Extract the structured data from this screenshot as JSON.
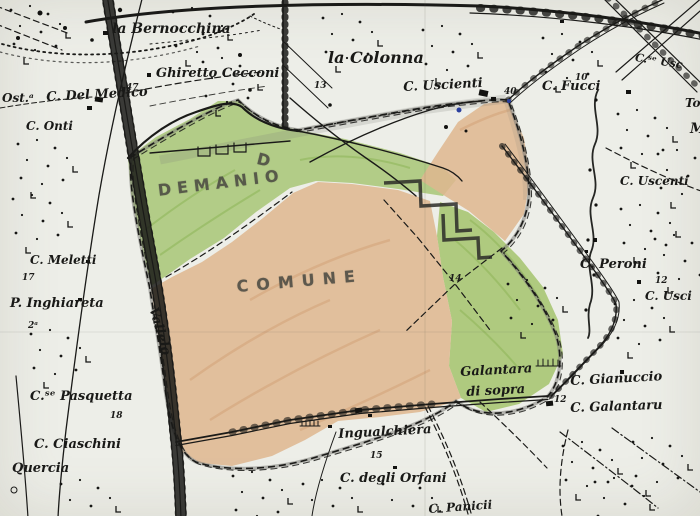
{
  "map": {
    "colors": {
      "paper": "#edeee8",
      "ink": "#1a1a18",
      "green_region": "#b2d37c",
      "orange_region": "#f0c49d",
      "pencil": "#7d7d78",
      "water_dot": "#2a3f9e"
    },
    "hand_labels": [
      {
        "t": "DEMANIO",
        "x": 157,
        "y": 183,
        "s": 16,
        "r": -7,
        "ls": 6
      },
      {
        "t": "COMUNE",
        "x": 236,
        "y": 279,
        "s": 16,
        "r": -5,
        "ls": 8
      },
      {
        "t": "D",
        "x": 259,
        "y": 151,
        "s": 16,
        "r": 14,
        "ls": 0
      }
    ],
    "place_labels": [
      {
        "t": "la Bernocchina",
        "x": 112,
        "y": 22,
        "s": 14
      },
      {
        "t": "Ghiretto Cecconi",
        "x": 156,
        "y": 67,
        "s": 13
      },
      {
        "t": "la Colonna",
        "x": 328,
        "y": 50,
        "s": 16
      },
      {
        "t": "C. Uscienti",
        "x": 403,
        "y": 81,
        "s": 13,
        "r": -3
      },
      {
        "t": "C. Fucci",
        "x": 542,
        "y": 80,
        "s": 13
      },
      {
        "t": "C.ˢᵉ Usc",
        "x": 636,
        "y": 52,
        "s": 11,
        "r": 9
      },
      {
        "t": "To",
        "x": 685,
        "y": 97,
        "s": 12
      },
      {
        "t": "M",
        "x": 690,
        "y": 122,
        "s": 14
      },
      {
        "t": "Ost.ᵃ",
        "x": 2,
        "y": 92,
        "s": 12
      },
      {
        "t": "C. Del Medico",
        "x": 46,
        "y": 91,
        "s": 13,
        "r": -3
      },
      {
        "t": "C. Onti",
        "x": 26,
        "y": 120,
        "s": 12
      },
      {
        "t": "C. Uscenti",
        "x": 620,
        "y": 175,
        "s": 12
      },
      {
        "t": "C. Meletti",
        "x": 30,
        "y": 254,
        "s": 12
      },
      {
        "t": "P. Inghiareta",
        "x": 10,
        "y": 297,
        "s": 13
      },
      {
        "t": "Vallelo",
        "x": 159,
        "y": 306,
        "s": 13,
        "r": 74
      },
      {
        "t": "C. Peroni",
        "x": 580,
        "y": 258,
        "s": 13
      },
      {
        "t": "C. Usci",
        "x": 645,
        "y": 290,
        "s": 12
      },
      {
        "t": "Galantara",
        "x": 460,
        "y": 366,
        "s": 13,
        "r": -3
      },
      {
        "t": "di  sopra",
        "x": 466,
        "y": 386,
        "s": 13,
        "r": -3
      },
      {
        "t": "C. Gianuccio",
        "x": 570,
        "y": 375,
        "s": 13,
        "r": -3
      },
      {
        "t": "C. Galantaru",
        "x": 570,
        "y": 402,
        "s": 13,
        "r": -2
      },
      {
        "t": "C.ˢᵉ Pasquetta",
        "x": 30,
        "y": 390,
        "s": 13
      },
      {
        "t": "C. Ciaschini",
        "x": 34,
        "y": 438,
        "s": 13
      },
      {
        "t": "Quercia",
        "x": 12,
        "y": 462,
        "s": 13
      },
      {
        "t": "Ingualchiera",
        "x": 338,
        "y": 428,
        "s": 13,
        "r": -3
      },
      {
        "t": "C. degli Orfani",
        "x": 340,
        "y": 472,
        "s": 13
      },
      {
        "t": "C. Panicii",
        "x": 428,
        "y": 503,
        "s": 12,
        "r": -4
      }
    ],
    "numbers": [
      {
        "t": "13",
        "x": 314,
        "y": 82
      },
      {
        "t": "40",
        "x": 504,
        "y": 88
      },
      {
        "t": "10",
        "x": 575,
        "y": 74
      },
      {
        "t": "47",
        "x": 126,
        "y": 84
      },
      {
        "t": "17",
        "x": 22,
        "y": 274
      },
      {
        "t": "2ᵃ",
        "x": 28,
        "y": 322
      },
      {
        "t": "14",
        "x": 449,
        "y": 275
      },
      {
        "t": "12",
        "x": 655,
        "y": 277
      },
      {
        "t": "12",
        "x": 554,
        "y": 396
      },
      {
        "t": "18",
        "x": 110,
        "y": 412
      },
      {
        "t": "15",
        "x": 370,
        "y": 452
      }
    ]
  }
}
